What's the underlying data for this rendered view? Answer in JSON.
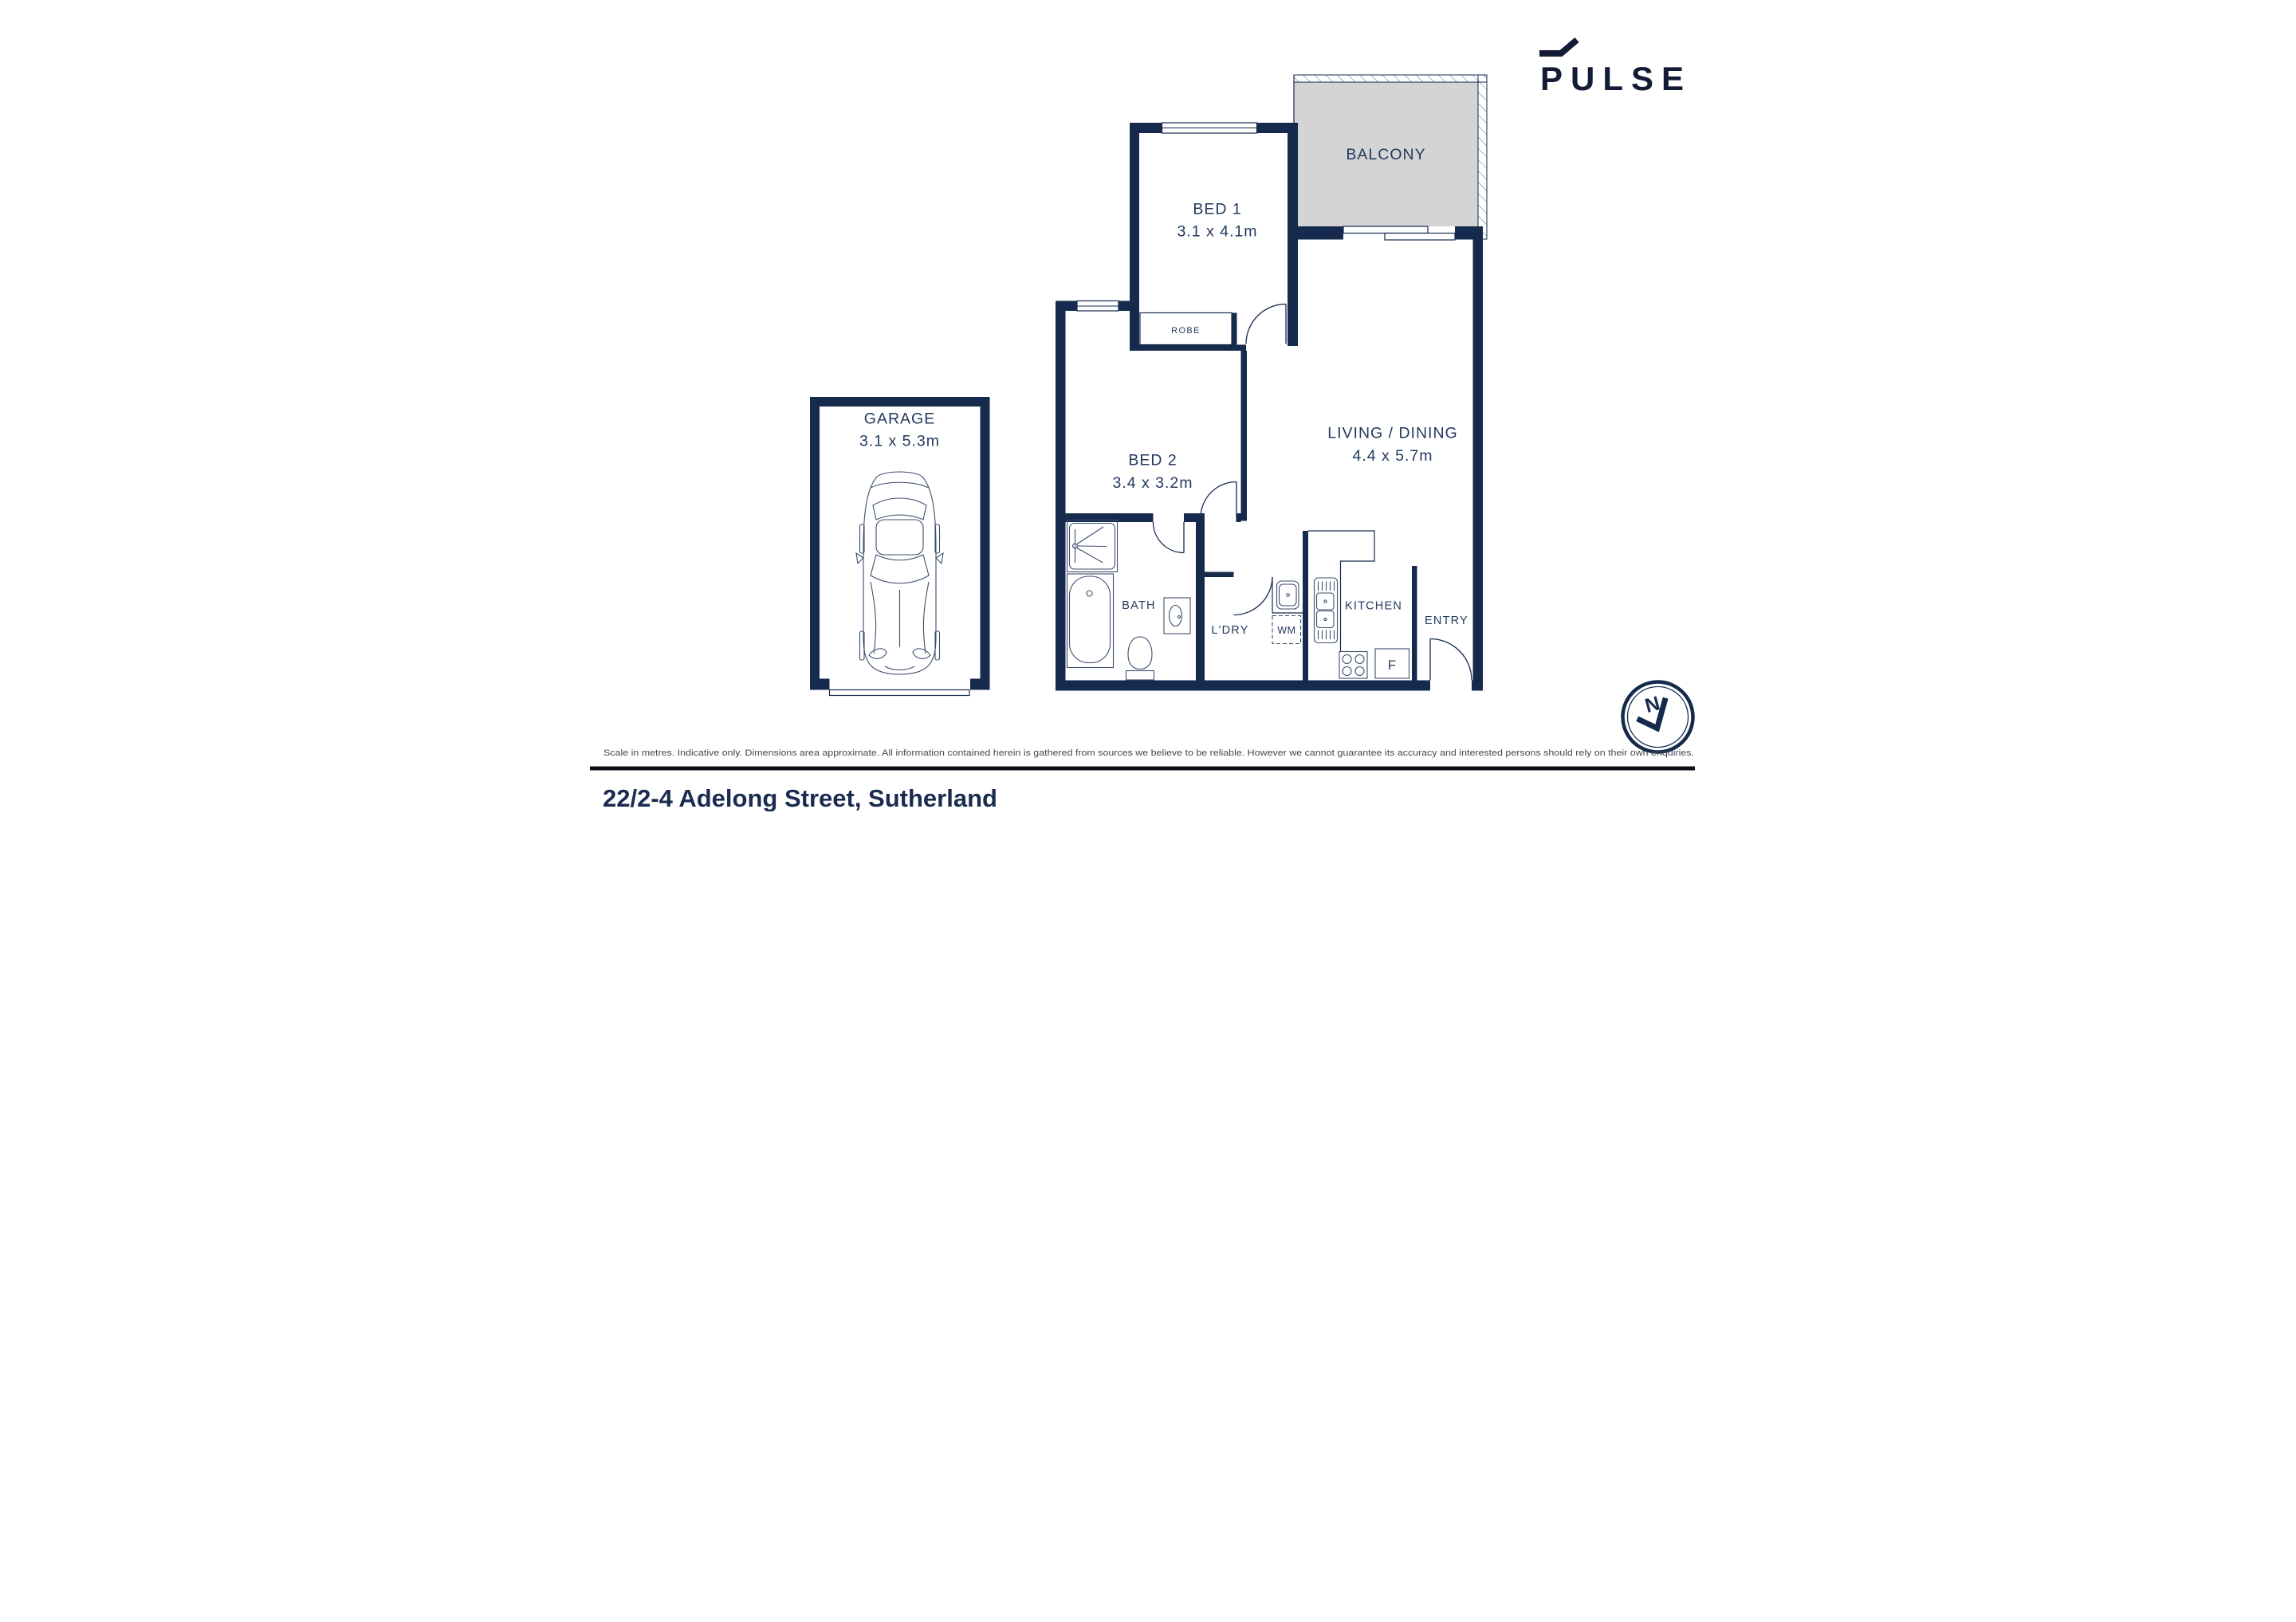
{
  "theme": {
    "wall_color": "#152a4c",
    "label_color": "#24395f",
    "balcony_fill": "#d4d4d4",
    "logo_color": "#131b36",
    "title_color": "#1b2b50",
    "disclaimer_color": "#41464f",
    "rule_color": "#101018",
    "bg": "#ffffff"
  },
  "logo": {
    "text": "PULSE"
  },
  "rooms": {
    "balcony": {
      "label": "BALCONY"
    },
    "bed1": {
      "label": "BED 1",
      "dims": "3.1 x 4.1m"
    },
    "bed2": {
      "label": "BED 2",
      "dims": "3.4 x 3.2m"
    },
    "living": {
      "label": "LIVING / DINING",
      "dims": "4.4 x 5.7m"
    },
    "robe": {
      "label": "ROBE"
    },
    "bath": {
      "label": "BATH"
    },
    "laundry": {
      "label": "L'DRY"
    },
    "wm": {
      "label": "WM"
    },
    "kitchen": {
      "label": "KITCHEN"
    },
    "entry": {
      "label": "ENTRY"
    },
    "fridge": {
      "label": "F"
    },
    "garage": {
      "label": "GARAGE",
      "dims": "3.1 x 5.3m"
    }
  },
  "compass": {
    "label": "N"
  },
  "footer": {
    "disclaimer": "Scale in metres. Indicative only. Dimensions area approximate. All information contained herein is gathered from sources we believe to be reliable. However we cannot guarantee its accuracy and interested persons should rely on their own enquiries.",
    "address": "22/2-4 Adelong Street, Sutherland"
  }
}
